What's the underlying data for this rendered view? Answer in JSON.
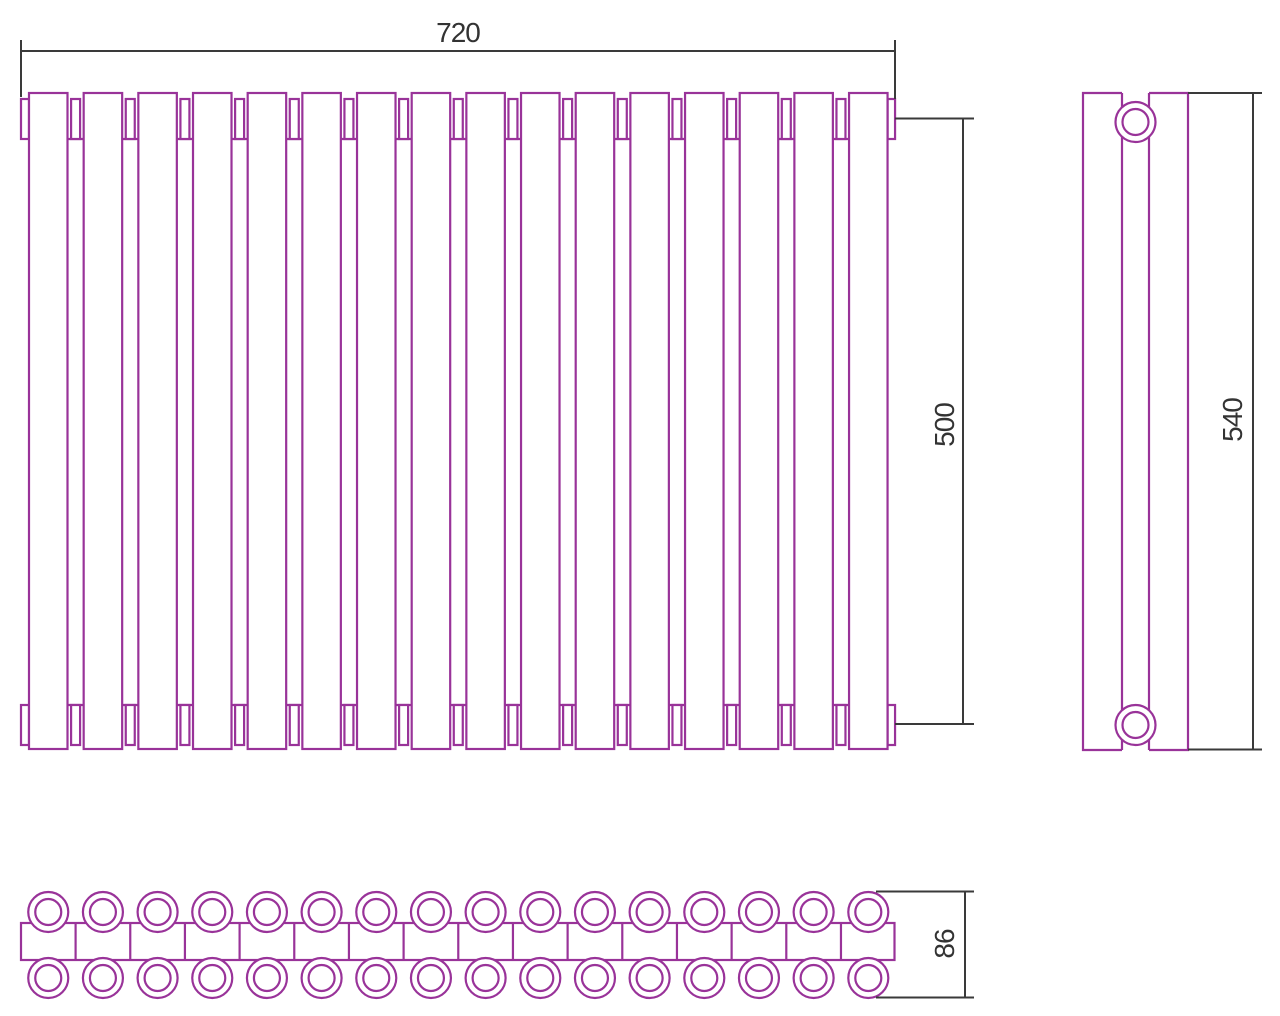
{
  "drawing": {
    "title": "Radiator technical drawing — three orthographic views",
    "background": "#ffffff",
    "colors": {
      "outline": "#993399",
      "dimension": "#3a3a3a",
      "label_text": "#333333"
    },
    "views": {
      "front": {
        "name": "front view",
        "sections": 16,
        "width_mm": "720",
        "axis_spacing_mm": "500"
      },
      "side": {
        "name": "side view",
        "height_mm": "540",
        "connection_ports": 2
      },
      "plan": {
        "name": "plan view",
        "tubes_per_row": 16,
        "tube_rows": 2,
        "depth_mm": "86"
      }
    },
    "dimensions": [
      {
        "id": "overall-width",
        "label": "720",
        "orientation": "horizontal"
      },
      {
        "id": "axis-spacing",
        "label": "500",
        "orientation": "vertical"
      },
      {
        "id": "overall-height",
        "label": "540",
        "orientation": "vertical"
      },
      {
        "id": "depth",
        "label": "86",
        "orientation": "vertical"
      }
    ]
  }
}
